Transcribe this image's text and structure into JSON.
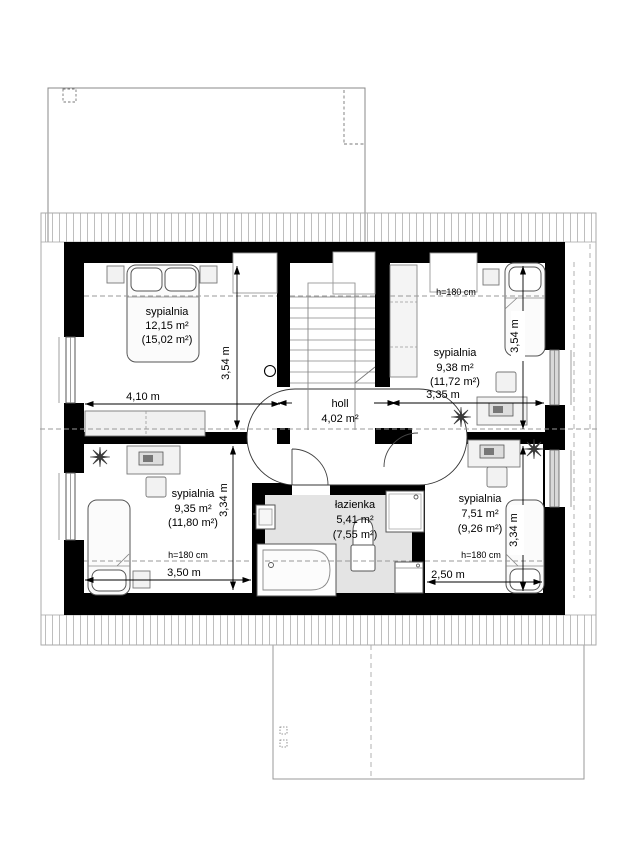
{
  "plan_title": "attic floor plan",
  "rooms": {
    "bedroom_tl": {
      "name": "sypialnia",
      "area": "12,15 m²",
      "area_total": "(15,02 m²)",
      "width": "4,10 m",
      "height": "3,54 m"
    },
    "bedroom_tr": {
      "name": "sypialnia",
      "area": "9,38 m²",
      "area_total": "(11,72 m²)",
      "width": "3,35 m",
      "height": "3,54 m",
      "knee_wall": "h=180 cm"
    },
    "bedroom_bl": {
      "name": "sypialnia",
      "area": "9,35 m²",
      "area_total": "(11,80 m²)",
      "width": "3,50 m",
      "height": "3,34 m",
      "knee_wall": "h=180 cm"
    },
    "bedroom_br": {
      "name": "sypialnia",
      "area": "7,51 m²",
      "area_total": "(9,26 m²)",
      "width": "2,50 m",
      "height": "3,34 m",
      "knee_wall": "h=180 cm"
    },
    "bathroom": {
      "name": "łazienka",
      "area": "5,41 m²",
      "area_total": "(7,55 m²)"
    },
    "hall": {
      "name": "holl",
      "area": "4,02 m²"
    }
  },
  "colors": {
    "wall": "#000000",
    "bathroom_floor": "#e4e4e4",
    "window_glass": "#d9d9d9",
    "dashed_line": "#999999",
    "hatch": "#adadad"
  }
}
